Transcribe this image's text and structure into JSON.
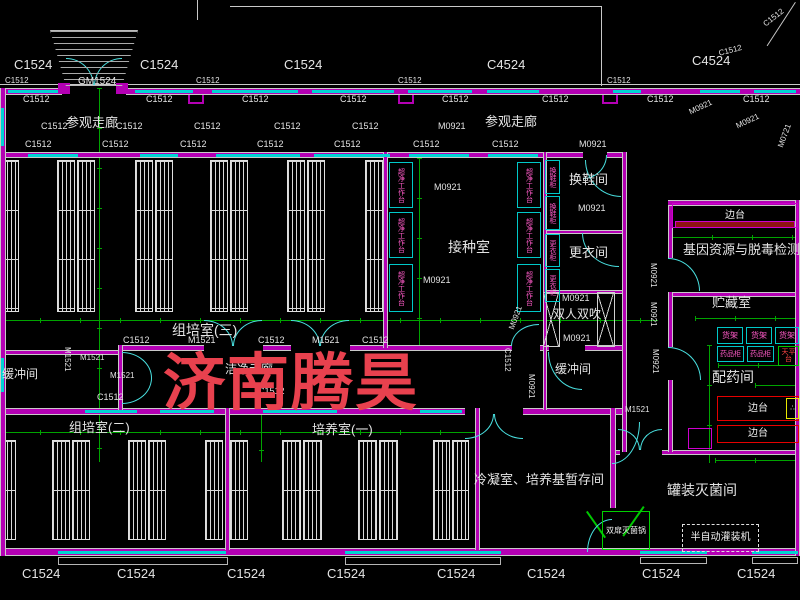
{
  "watermark": {
    "text": "济南腾昊",
    "x": 163,
    "y": 332,
    "size": 62,
    "letter_spacing": 2,
    "color": "#e8414e"
  },
  "colors": {
    "wall": "#b400b4",
    "window": "#00d4d4",
    "dimension": "#00a400",
    "door": "#49e0e0",
    "equip_border": "#00c8c8",
    "equip_text": "#ff5ac8",
    "bench_red": "#e60000",
    "watermark": "#e8414e"
  },
  "labels": [
    {
      "t": "C1524",
      "x": 14,
      "y": 58,
      "s": 13
    },
    {
      "t": "C1524",
      "x": 140,
      "y": 58,
      "s": 13
    },
    {
      "t": "C1524",
      "x": 284,
      "y": 58,
      "s": 13
    },
    {
      "t": "C4524",
      "x": 487,
      "y": 58,
      "s": 13
    },
    {
      "t": "C4524",
      "x": 692,
      "y": 54,
      "s": 13
    },
    {
      "t": "C1512",
      "x": 718,
      "y": 50,
      "s": 8,
      "r": -15
    },
    {
      "t": "C1512",
      "x": 762,
      "y": 22,
      "s": 8,
      "r": -38
    },
    {
      "t": "GM1524",
      "x": 78,
      "y": 77,
      "s": 10
    },
    {
      "t": "C1512",
      "x": 5,
      "y": 77,
      "s": 8
    },
    {
      "t": "C1512",
      "x": 196,
      "y": 77,
      "s": 8
    },
    {
      "t": "C1512",
      "x": 398,
      "y": 77,
      "s": 8
    },
    {
      "t": "C1512",
      "x": 607,
      "y": 77,
      "s": 8
    },
    {
      "t": "C1512",
      "x": 23,
      "y": 95,
      "s": 9
    },
    {
      "t": "C1512",
      "x": 146,
      "y": 95,
      "s": 9
    },
    {
      "t": "C1512",
      "x": 242,
      "y": 95,
      "s": 9
    },
    {
      "t": "C1512",
      "x": 340,
      "y": 95,
      "s": 9
    },
    {
      "t": "C1512",
      "x": 442,
      "y": 95,
      "s": 9
    },
    {
      "t": "C1512",
      "x": 542,
      "y": 95,
      "s": 9
    },
    {
      "t": "C1512",
      "x": 647,
      "y": 95,
      "s": 9
    },
    {
      "t": "C1512",
      "x": 743,
      "y": 95,
      "s": 9
    },
    {
      "t": "参观走廊",
      "x": 66,
      "y": 116,
      "s": 13
    },
    {
      "t": "参观走廊",
      "x": 485,
      "y": 115,
      "s": 13
    },
    {
      "t": "C1512",
      "x": 41,
      "y": 122,
      "s": 9
    },
    {
      "t": "C1512",
      "x": 116,
      "y": 122,
      "s": 9
    },
    {
      "t": "C1512",
      "x": 194,
      "y": 122,
      "s": 9
    },
    {
      "t": "C1512",
      "x": 274,
      "y": 122,
      "s": 9
    },
    {
      "t": "C1512",
      "x": 352,
      "y": 122,
      "s": 9
    },
    {
      "t": "M0921",
      "x": 438,
      "y": 122,
      "s": 9
    },
    {
      "t": "M0921",
      "x": 688,
      "y": 109,
      "s": 8,
      "r": -25
    },
    {
      "t": "M0921",
      "x": 735,
      "y": 123,
      "s": 8,
      "r": -25
    },
    {
      "t": "M0721",
      "x": 777,
      "y": 146,
      "s": 8,
      "r": -70
    },
    {
      "t": "C1512",
      "x": 25,
      "y": 140,
      "s": 9
    },
    {
      "t": "C1512",
      "x": 102,
      "y": 140,
      "s": 9
    },
    {
      "t": "C1512",
      "x": 180,
      "y": 140,
      "s": 9
    },
    {
      "t": "C1512",
      "x": 257,
      "y": 140,
      "s": 9
    },
    {
      "t": "C1512",
      "x": 334,
      "y": 140,
      "s": 9
    },
    {
      "t": "C1512",
      "x": 413,
      "y": 140,
      "s": 9
    },
    {
      "t": "C1512",
      "x": 492,
      "y": 140,
      "s": 9
    },
    {
      "t": "M0921",
      "x": 579,
      "y": 140,
      "s": 9
    },
    {
      "t": "M0921",
      "x": 434,
      "y": 183,
      "s": 9
    },
    {
      "t": "M0921",
      "x": 423,
      "y": 276,
      "s": 9
    },
    {
      "t": "接种室",
      "x": 448,
      "y": 240,
      "s": 14
    },
    {
      "t": "换鞋间",
      "x": 569,
      "y": 173,
      "s": 13
    },
    {
      "t": "M0921",
      "x": 578,
      "y": 204,
      "s": 9
    },
    {
      "t": "更衣间",
      "x": 569,
      "y": 246,
      "s": 13
    },
    {
      "t": "M0921",
      "x": 562,
      "y": 294,
      "s": 9
    },
    {
      "t": "双人双吹",
      "x": 553,
      "y": 308,
      "s": 12
    },
    {
      "t": "M0921",
      "x": 563,
      "y": 334,
      "s": 9
    },
    {
      "t": "缓冲间",
      "x": 555,
      "y": 363,
      "s": 12
    },
    {
      "t": "M0921",
      "x": 649,
      "y": 263,
      "s": 8,
      "v": 1
    },
    {
      "t": "M0921",
      "x": 649,
      "y": 302,
      "s": 8,
      "v": 1
    },
    {
      "t": "M0921",
      "x": 651,
      "y": 349,
      "s": 8,
      "v": 1
    },
    {
      "t": "基因资源与脱毒检测室",
      "x": 683,
      "y": 243,
      "s": 13
    },
    {
      "t": "贮藏室",
      "x": 712,
      "y": 296,
      "s": 13
    },
    {
      "t": "配药间",
      "x": 712,
      "y": 370,
      "s": 14
    },
    {
      "t": "罐装灭菌间",
      "x": 667,
      "y": 483,
      "s": 14
    },
    {
      "t": "M1521",
      "x": 625,
      "y": 406,
      "s": 8
    },
    {
      "t": "组培室(三)",
      "x": 172,
      "y": 323,
      "s": 14
    },
    {
      "t": "C1512",
      "x": 123,
      "y": 336,
      "s": 9
    },
    {
      "t": "M1521",
      "x": 188,
      "y": 336,
      "s": 9
    },
    {
      "t": "C1512",
      "x": 258,
      "y": 336,
      "s": 9
    },
    {
      "t": "M1521",
      "x": 312,
      "y": 336,
      "s": 9
    },
    {
      "t": "C1512",
      "x": 362,
      "y": 336,
      "s": 9
    },
    {
      "t": "缓冲间",
      "x": 2,
      "y": 368,
      "s": 12
    },
    {
      "t": "M1521",
      "x": 110,
      "y": 372,
      "s": 8
    },
    {
      "t": "M1521",
      "x": 80,
      "y": 354,
      "s": 8
    },
    {
      "t": "M1521",
      "x": 63,
      "y": 347,
      "s": 8,
      "v": 1
    },
    {
      "t": "洁净走廊",
      "x": 225,
      "y": 363,
      "s": 12
    },
    {
      "t": "C1512",
      "x": 503,
      "y": 348,
      "s": 8,
      "v": 1
    },
    {
      "t": "M0921",
      "x": 508,
      "y": 328,
      "s": 8,
      "r": -70
    },
    {
      "t": "M0921",
      "x": 527,
      "y": 374,
      "s": 8,
      "v": 1
    },
    {
      "t": "C1512",
      "x": 97,
      "y": 393,
      "s": 9
    },
    {
      "t": "C1512",
      "x": 258,
      "y": 387,
      "s": 9
    },
    {
      "t": "组培室(二)",
      "x": 69,
      "y": 421,
      "s": 13
    },
    {
      "t": "培养室(一)",
      "x": 312,
      "y": 423,
      "s": 13
    },
    {
      "t": "冷凝室、培养基暂存间",
      "x": 474,
      "y": 473,
      "s": 13
    },
    {
      "t": "C1524",
      "x": 22,
      "y": 567,
      "s": 13
    },
    {
      "t": "C1524",
      "x": 117,
      "y": 567,
      "s": 13
    },
    {
      "t": "C1524",
      "x": 227,
      "y": 567,
      "s": 13
    },
    {
      "t": "C1524",
      "x": 327,
      "y": 567,
      "s": 13
    },
    {
      "t": "C1524",
      "x": 437,
      "y": 567,
      "s": 13
    },
    {
      "t": "C1524",
      "x": 527,
      "y": 567,
      "s": 13
    },
    {
      "t": "C1524",
      "x": 642,
      "y": 567,
      "s": 13
    },
    {
      "t": "C1524",
      "x": 737,
      "y": 567,
      "s": 13
    }
  ],
  "equipment": [
    {
      "n": "clean-bench",
      "t": "超净工作台",
      "x": 389,
      "y": 162,
      "w": 24,
      "h": 46,
      "v": 1
    },
    {
      "n": "clean-bench",
      "t": "超净工作台",
      "x": 389,
      "y": 212,
      "w": 24,
      "h": 46,
      "v": 1
    },
    {
      "n": "clean-bench",
      "t": "超净工作台",
      "x": 389,
      "y": 264,
      "w": 24,
      "h": 48,
      "v": 1
    },
    {
      "n": "clean-bench",
      "t": "超净工作台",
      "x": 517,
      "y": 162,
      "w": 24,
      "h": 46,
      "v": 1
    },
    {
      "n": "clean-bench",
      "t": "超净工作台",
      "x": 517,
      "y": 212,
      "w": 24,
      "h": 46,
      "v": 1
    },
    {
      "n": "clean-bench",
      "t": "超净工作台",
      "x": 517,
      "y": 264,
      "w": 24,
      "h": 48,
      "v": 1
    },
    {
      "n": "shoe-cabinet",
      "t": "换鞋柜",
      "x": 545,
      "y": 160,
      "w": 15,
      "h": 34,
      "v": 1
    },
    {
      "n": "shoe-cabinet",
      "t": "换鞋柜",
      "x": 545,
      "y": 196,
      "w": 15,
      "h": 34,
      "v": 1
    },
    {
      "n": "wardrobe",
      "t": "更衣柜",
      "x": 545,
      "y": 234,
      "w": 15,
      "h": 33,
      "v": 1
    },
    {
      "n": "wardrobe",
      "t": "更衣柜",
      "x": 545,
      "y": 269,
      "w": 15,
      "h": 33,
      "v": 1
    },
    {
      "n": "shelf-rack",
      "t": "货架",
      "x": 717,
      "y": 327,
      "w": 26,
      "h": 17,
      "s": 8
    },
    {
      "n": "shelf-rack",
      "t": "货架",
      "x": 746,
      "y": 327,
      "w": 26,
      "h": 17,
      "s": 8
    },
    {
      "n": "shelf-rack",
      "t": "货架",
      "x": 775,
      "y": 327,
      "w": 24,
      "h": 17,
      "s": 8
    },
    {
      "n": "medicine-cabinet",
      "t": "药品柜",
      "x": 717,
      "y": 346,
      "w": 27,
      "h": 16,
      "s": 7
    },
    {
      "n": "medicine-cabinet",
      "t": "药品柜",
      "x": 747,
      "y": 346,
      "w": 27,
      "h": 16,
      "s": 7
    },
    {
      "n": "balance-table",
      "t": "天平台",
      "x": 778,
      "y": 346,
      "w": 21,
      "h": 20,
      "b": "#00c800",
      "tc": "#ff4545",
      "s": 7
    },
    {
      "n": "side-bench",
      "t": "边台",
      "x": 672,
      "y": 203,
      "w": 126,
      "h": 25,
      "b": "#cf00cf",
      "tc": "#f0f0f0",
      "s": 10
    },
    {
      "n": "side-bench-top",
      "t": "",
      "x": 675,
      "y": 221,
      "w": 120,
      "h": 7,
      "b": "#cf00cf",
      "f": "#8e1212"
    },
    {
      "n": "side-bench",
      "t": "边台",
      "x": 717,
      "y": 396,
      "w": 82,
      "h": 25,
      "b": "#e60000",
      "tc": "#f0f0f0",
      "s": 10
    },
    {
      "n": "side-bench",
      "t": "边台",
      "x": 717,
      "y": 425,
      "w": 82,
      "h": 18,
      "b": "#e60000",
      "tc": "#f0f0f0",
      "s": 10
    },
    {
      "n": "sink",
      "t": "∴",
      "x": 786,
      "y": 398,
      "w": 13,
      "h": 21,
      "b": "#e8e800",
      "tc": "#ffffff",
      "s": 7
    },
    {
      "n": "filling-machine",
      "t": "半自动灌装机",
      "x": 682,
      "y": 524,
      "w": 77,
      "h": 28,
      "b": "#e0e0e0",
      "tc": "#f0f0f0",
      "s": 10,
      "ds": 1
    },
    {
      "n": "sterilizer",
      "t": "双扉灭菌锅",
      "x": 602,
      "y": 511,
      "w": 48,
      "h": 39,
      "b": "#00d000",
      "tc": "#f0f0f0",
      "s": 8
    },
    {
      "n": "utility-box",
      "t": "",
      "x": 688,
      "y": 428,
      "w": 24,
      "h": 21,
      "b": "#cf00cf"
    }
  ],
  "walls_h": [
    [
      0,
      88,
      62,
      7
    ],
    [
      126,
      88,
      674,
      7
    ],
    [
      0,
      152,
      583,
      6
    ],
    [
      607,
      152,
      18,
      6
    ],
    [
      0,
      350,
      122,
      5
    ],
    [
      120,
      345,
      84,
      6
    ],
    [
      263,
      345,
      28,
      6
    ],
    [
      350,
      345,
      162,
      6
    ],
    [
      540,
      345,
      9,
      6
    ],
    [
      585,
      345,
      40,
      6
    ],
    [
      545,
      230,
      80,
      4
    ],
    [
      545,
      290,
      80,
      4
    ],
    [
      0,
      408,
      465,
      7
    ],
    [
      523,
      408,
      103,
      7
    ],
    [
      668,
      200,
      132,
      6
    ],
    [
      668,
      292,
      132,
      5
    ],
    [
      610,
      450,
      10,
      5
    ],
    [
      662,
      450,
      138,
      5
    ],
    [
      0,
      548,
      800,
      8
    ]
  ],
  "walls_v": [
    [
      0,
      88,
      6,
      468
    ],
    [
      383,
      152,
      5,
      196
    ],
    [
      543,
      152,
      4,
      258
    ],
    [
      622,
      152,
      5,
      300
    ],
    [
      668,
      206,
      5,
      52
    ],
    [
      668,
      292,
      5,
      55
    ],
    [
      668,
      380,
      5,
      72
    ],
    [
      610,
      408,
      6,
      100
    ],
    [
      795,
      200,
      5,
      356
    ],
    [
      225,
      408,
      5,
      142
    ],
    [
      475,
      408,
      5,
      142
    ],
    [
      118,
      345,
      5,
      66
    ]
  ],
  "windows_h": [
    [
      8,
      90,
      50
    ],
    [
      135,
      90,
      58
    ],
    [
      212,
      90,
      86
    ],
    [
      312,
      90,
      82
    ],
    [
      408,
      90,
      64
    ],
    [
      487,
      90,
      52
    ],
    [
      613,
      90,
      28
    ],
    [
      700,
      90,
      40
    ],
    [
      754,
      90,
      42
    ],
    [
      28,
      154,
      50
    ],
    [
      140,
      154,
      38
    ],
    [
      216,
      154,
      84
    ],
    [
      314,
      154,
      76
    ],
    [
      409,
      154,
      60
    ],
    [
      488,
      154,
      50
    ],
    [
      85,
      410,
      52
    ],
    [
      160,
      410,
      54
    ],
    [
      263,
      410,
      74
    ],
    [
      420,
      410,
      42
    ],
    [
      58,
      551,
      168
    ],
    [
      345,
      551,
      156
    ],
    [
      640,
      551,
      67
    ],
    [
      752,
      551,
      46
    ]
  ],
  "windows_v": [
    [
      1,
      108,
      38
    ],
    [
      1,
      358,
      34
    ]
  ],
  "green_h": [
    [
      0,
      318,
      658
    ],
    [
      0,
      430,
      478
    ],
    [
      672,
      235,
      128
    ],
    [
      695,
      316,
      105
    ],
    [
      718,
      363,
      82
    ],
    [
      715,
      458,
      85
    ],
    [
      755,
      383,
      45
    ]
  ],
  "green_v": [
    [
      97,
      88,
      374
    ],
    [
      417,
      158,
      188
    ],
    [
      259,
      410,
      52
    ],
    [
      707,
      345,
      118
    ]
  ],
  "white_lines": [
    [
      0,
      84,
      800,
      1
    ],
    [
      230,
      6,
      371,
      1
    ],
    [
      601,
      6,
      1,
      80
    ],
    [
      197,
      0,
      1,
      20
    ]
  ],
  "diag_lines": [
    [
      795,
      2,
      52,
      33
    ]
  ],
  "green_slashes": [
    [
      586,
      512,
      32,
      -35
    ],
    [
      643,
      506,
      36,
      35
    ]
  ],
  "sills": [
    [
      58,
      557,
      170,
      8
    ],
    [
      345,
      557,
      156,
      8
    ],
    [
      640,
      557,
      67,
      7
    ],
    [
      752,
      557,
      46,
      7
    ]
  ],
  "notches": [
    [
      188,
      95,
      16,
      9
    ],
    [
      398,
      95,
      16,
      9
    ],
    [
      602,
      95,
      16,
      9
    ]
  ],
  "posts": [
    [
      58,
      83,
      12,
      11
    ],
    [
      116,
      83,
      12,
      11
    ]
  ],
  "x_marks": [
    [
      543,
      292,
      17,
      55
    ],
    [
      597,
      292,
      18,
      55
    ]
  ],
  "stairs": {
    "x": 50,
    "y": 30,
    "w": 88,
    "h": 56
  },
  "racks": [
    [
      2,
      160,
      17,
      152
    ],
    [
      57,
      160,
      18,
      152
    ],
    [
      77,
      160,
      18,
      152
    ],
    [
      135,
      160,
      18,
      152
    ],
    [
      155,
      160,
      18,
      152
    ],
    [
      210,
      160,
      18,
      152
    ],
    [
      230,
      160,
      18,
      152
    ],
    [
      287,
      160,
      18,
      152
    ],
    [
      307,
      160,
      18,
      152
    ],
    [
      365,
      160,
      18,
      152
    ],
    [
      2,
      440,
      14,
      100
    ],
    [
      52,
      440,
      18,
      100
    ],
    [
      72,
      440,
      18,
      100
    ],
    [
      128,
      440,
      18,
      100
    ],
    [
      148,
      440,
      18,
      100
    ],
    [
      205,
      440,
      18,
      100
    ],
    [
      230,
      440,
      18,
      100
    ],
    [
      282,
      440,
      19,
      100
    ],
    [
      303,
      440,
      19,
      100
    ],
    [
      358,
      440,
      19,
      100
    ],
    [
      379,
      440,
      19,
      100
    ],
    [
      433,
      440,
      17,
      100
    ],
    [
      452,
      440,
      17,
      100
    ]
  ],
  "doors": [
    [
      66,
      58,
      28,
      28,
      "tr"
    ],
    [
      94,
      58,
      28,
      28,
      "tl"
    ],
    [
      583,
      155,
      24,
      24,
      "br"
    ],
    [
      585,
      160,
      36,
      37,
      "bl"
    ],
    [
      582,
      233,
      37,
      34,
      "bl"
    ],
    [
      668,
      258,
      32,
      33,
      "tr"
    ],
    [
      668,
      347,
      33,
      33,
      "tr"
    ],
    [
      618,
      429,
      22,
      21,
      "tr"
    ],
    [
      640,
      429,
      22,
      21,
      "tl"
    ],
    [
      204,
      320,
      29,
      26,
      "tr"
    ],
    [
      233,
      320,
      29,
      26,
      "tl"
    ],
    [
      291,
      320,
      29,
      26,
      "tr"
    ],
    [
      320,
      320,
      29,
      26,
      "tl"
    ],
    [
      122,
      352,
      30,
      26,
      "tr"
    ],
    [
      122,
      378,
      30,
      26,
      "br"
    ],
    [
      511,
      324,
      28,
      22,
      "tl"
    ],
    [
      548,
      352,
      34,
      38,
      "bl"
    ],
    [
      465,
      414,
      29,
      25,
      "br"
    ],
    [
      494,
      414,
      29,
      25,
      "bl"
    ],
    [
      587,
      519,
      25,
      33,
      "tl"
    ],
    [
      612,
      422,
      28,
      42,
      "br"
    ]
  ]
}
